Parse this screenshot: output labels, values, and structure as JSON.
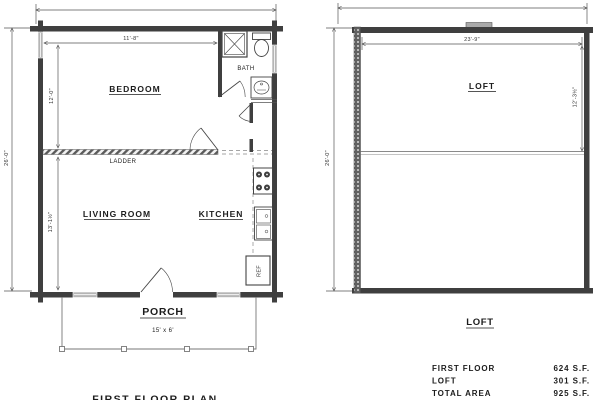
{
  "first_floor": {
    "title": "FIRST FLOOR PLAN",
    "rooms": {
      "bedroom": "BEDROOM",
      "bath": "BATH",
      "living_room": "LIVING ROOM",
      "kitchen": "KITCHEN",
      "porch": "PORCH",
      "ladder": "LADDER",
      "ref": "REF"
    },
    "dimensions": {
      "bedroom_width": "11'-8\"",
      "bedroom_depth": "12'-0\"",
      "living_depth": "13'-1½\"",
      "overall_depth": "26'-0\"",
      "porch_size": "15' x 6'"
    }
  },
  "loft": {
    "title": "LOFT",
    "room_label": "LOFT",
    "dimensions": {
      "width": "23'-9\"",
      "depth": "12'-3½\"",
      "overall_depth": "26'-0\""
    }
  },
  "area_table": {
    "rows": [
      {
        "label": "FIRST FLOOR",
        "value": "624 S.F."
      },
      {
        "label": "LOFT",
        "value": "301 S.F."
      },
      {
        "label": "TOTAL AREA",
        "value": "925 S.F."
      }
    ]
  },
  "colors": {
    "wall": "#3f3f3f",
    "window": "#b5b5b5",
    "line": "#6a6a6a",
    "text": "#1c1c1c"
  }
}
